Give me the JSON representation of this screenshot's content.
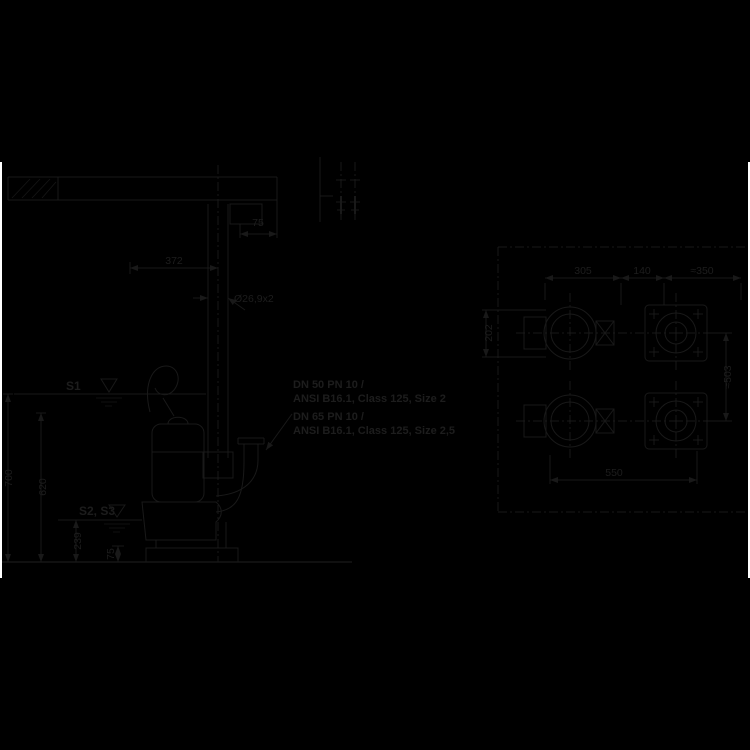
{
  "canvas": {
    "background": "#000000",
    "line_color": "#191919",
    "text_color": "#1d1d1d",
    "edge_strip_color": "#ffffff"
  },
  "side": {
    "s1": "S1",
    "s2s3": "S2, S3",
    "note1_line1": "DN 50 PN 10 /",
    "note1_line2": "ANSI B16.1, Class 125, Size 2",
    "note2_line1": "DN 65 PN 10 /",
    "note2_line2": "ANSI B16.1, Class 125, Size 2,5",
    "dims": {
      "bracket": "75",
      "rail": "372",
      "pipe": "Ø26,9x2",
      "depth_total": "700",
      "depth_mid": "620",
      "depth_stop": "239",
      "clearance": "75"
    }
  },
  "plan": {
    "dims": {
      "top_a": "305",
      "top_b": "140",
      "top_c": "≈350",
      "left": "202",
      "right": "≈503",
      "bottom": "550"
    }
  }
}
